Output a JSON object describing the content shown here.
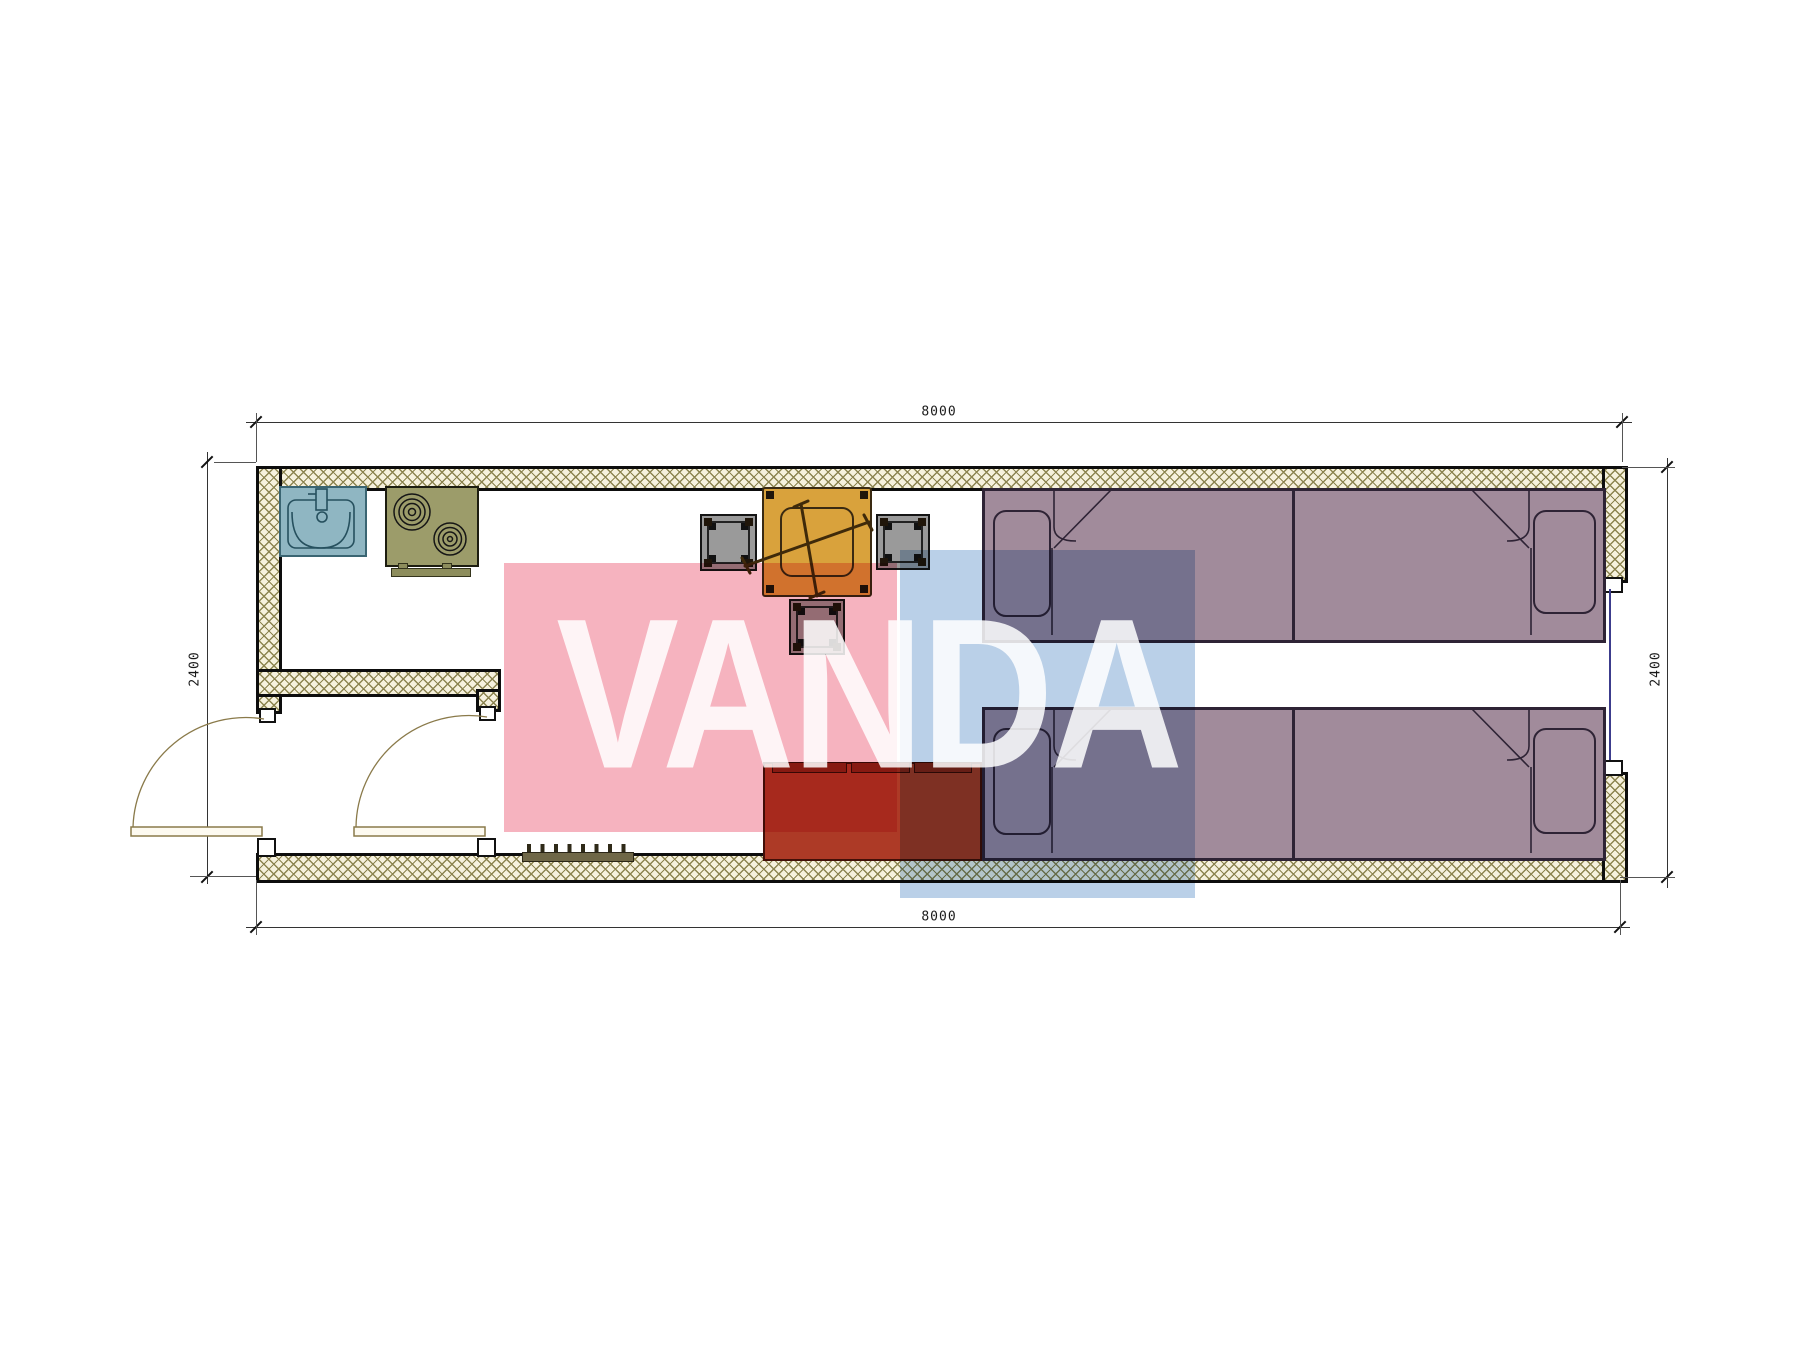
{
  "watermark": {
    "text": "VANDA"
  },
  "dimensions": {
    "top": "8000",
    "bottom": "8000",
    "left": "2400",
    "right": "2400"
  },
  "colors": {
    "watermark_pink": "#f6b3bf",
    "watermark_blue": "#bad0e8",
    "wall_hatch_bg": "#f6f1dd",
    "wall_hatch_line": "#8c8450",
    "wall_edge": "#0d0d0d",
    "dim_line": "#333333",
    "sink": "#8fb6c2",
    "stove": "#9c9c6a",
    "table": "#d9a23c",
    "stool": "#9a9a9a",
    "sofa": "#ad3a26",
    "sofa_cushion": "#8c2418",
    "bed": "#a18b9b",
    "bed_line": "#2e2335",
    "door": "#8a7a4a",
    "rack": "#6f6747",
    "window": "#3c3c8c"
  },
  "furniture": [
    {
      "name": "sink",
      "color_key": "sink"
    },
    {
      "name": "cooktop-stove",
      "color_key": "stove"
    },
    {
      "name": "dining-table",
      "color_key": "table"
    },
    {
      "name": "stool-left",
      "color_key": "stool"
    },
    {
      "name": "stool-right",
      "color_key": "stool"
    },
    {
      "name": "stool-bottom",
      "color_key": "stool"
    },
    {
      "name": "sofa",
      "color_key": "sofa"
    },
    {
      "name": "bed-top-left",
      "color_key": "bed"
    },
    {
      "name": "bed-top-right",
      "color_key": "bed"
    },
    {
      "name": "bed-bottom-left",
      "color_key": "bed"
    },
    {
      "name": "bed-bottom-right",
      "color_key": "bed"
    },
    {
      "name": "coat-rack",
      "color_key": "rack"
    },
    {
      "name": "entry-door-exterior",
      "color_key": "door"
    },
    {
      "name": "entry-door-interior",
      "color_key": "door"
    },
    {
      "name": "window-right-wall",
      "color_key": "window"
    }
  ]
}
